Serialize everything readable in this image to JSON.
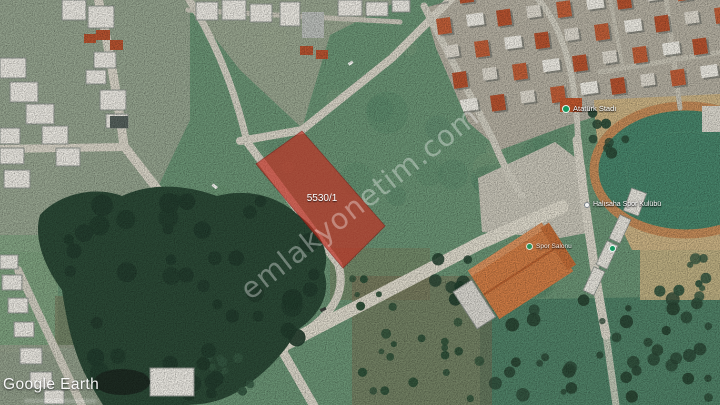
{
  "map": {
    "attribution": "Google Earth",
    "watermark": {
      "text": "emlakyonetim.com",
      "color": "#ffffff"
    },
    "parcel": {
      "label": "5530/1",
      "fill_color": "#c22f22"
    },
    "labels": {
      "stadium": {
        "text": "Atatürk Stadı",
        "icon": "green-place-dot-icon"
      },
      "sports_club": {
        "text": "Halısaha Spor Kulübü",
        "icon": "map-pin-icon"
      },
      "sports_hall": {
        "text": "Spor Salonu",
        "icon": "green-place-dot-icon"
      }
    },
    "colors": {
      "field_green": "#6a9374",
      "forest_green": "#2b4936",
      "road_gray": "#d7d3c6",
      "track_tan": "#c28a58",
      "stadium_field": "#47846a",
      "roof_orange": "#cf7c45",
      "roof_red": "#b5522f",
      "place_dot_green": "#14995f"
    }
  }
}
